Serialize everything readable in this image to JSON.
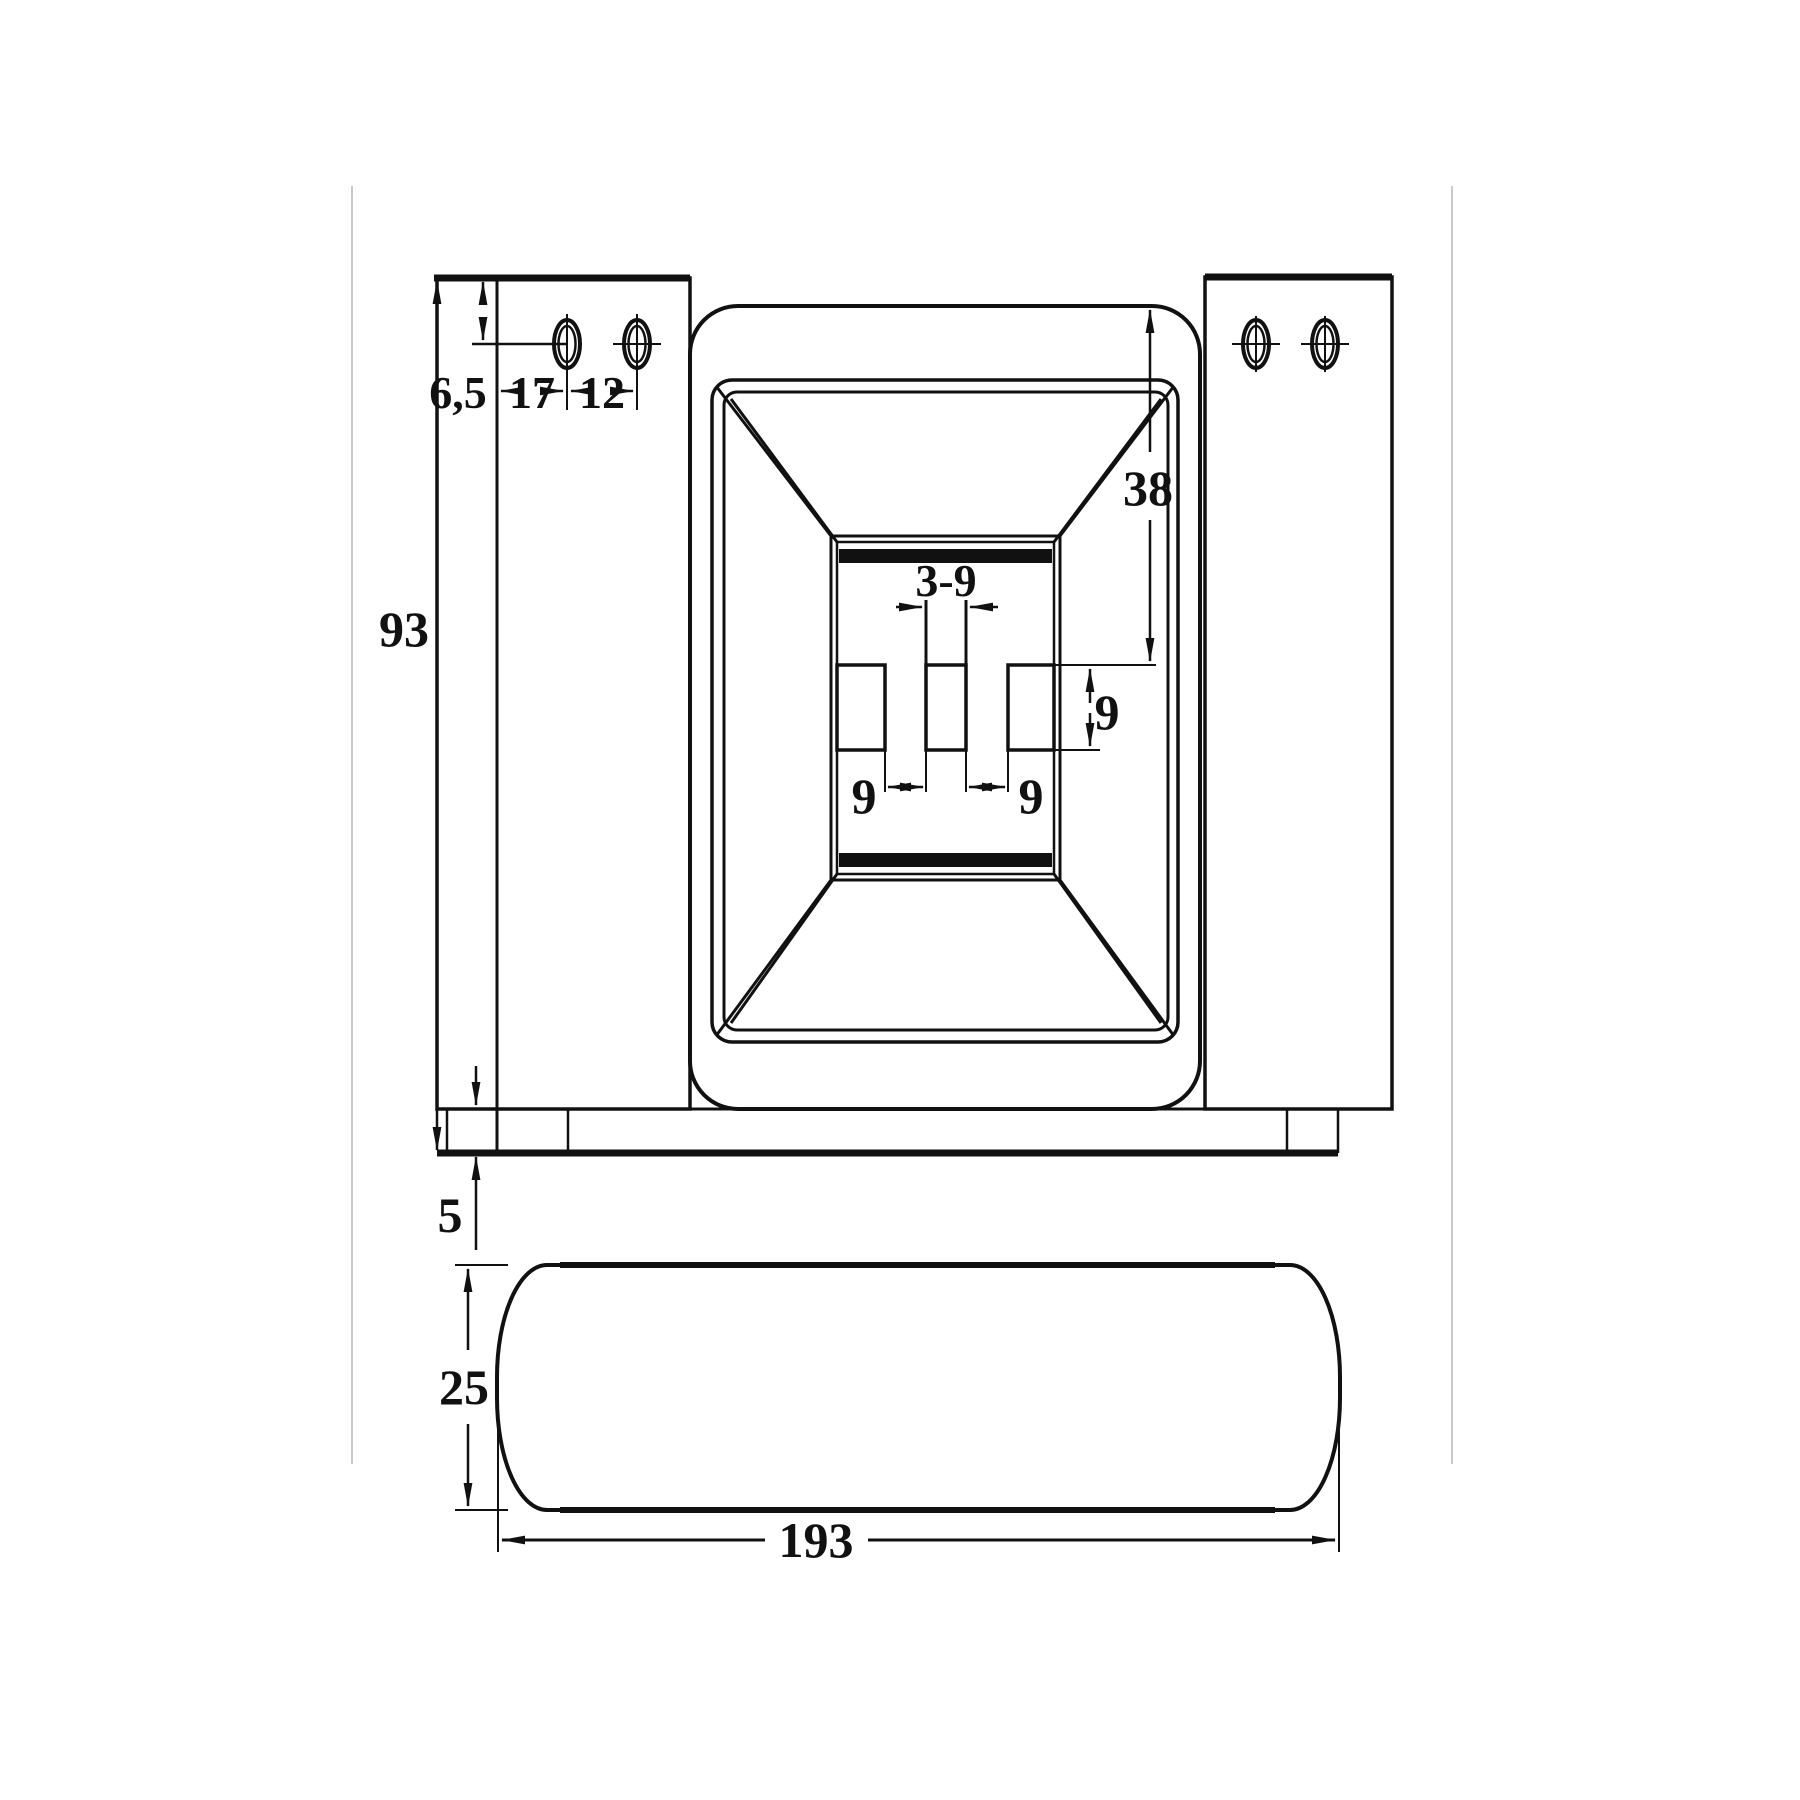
{
  "drawing": {
    "background": "#ffffff",
    "ink": "#111111",
    "guide_color": "#c9c9c9",
    "front_view": {
      "hole_offset_top": "6,5",
      "hole_inset": "17",
      "hole_pitch": "12",
      "overall_height": "93",
      "recess_depth": "38",
      "center_slot": "3-9",
      "slot_gap_left": "9",
      "slot_gap_right": "9",
      "slot_band_height": "9",
      "base_thickness": "5"
    },
    "bottom_view": {
      "profile_thickness": "25",
      "overall_width": "193"
    }
  }
}
